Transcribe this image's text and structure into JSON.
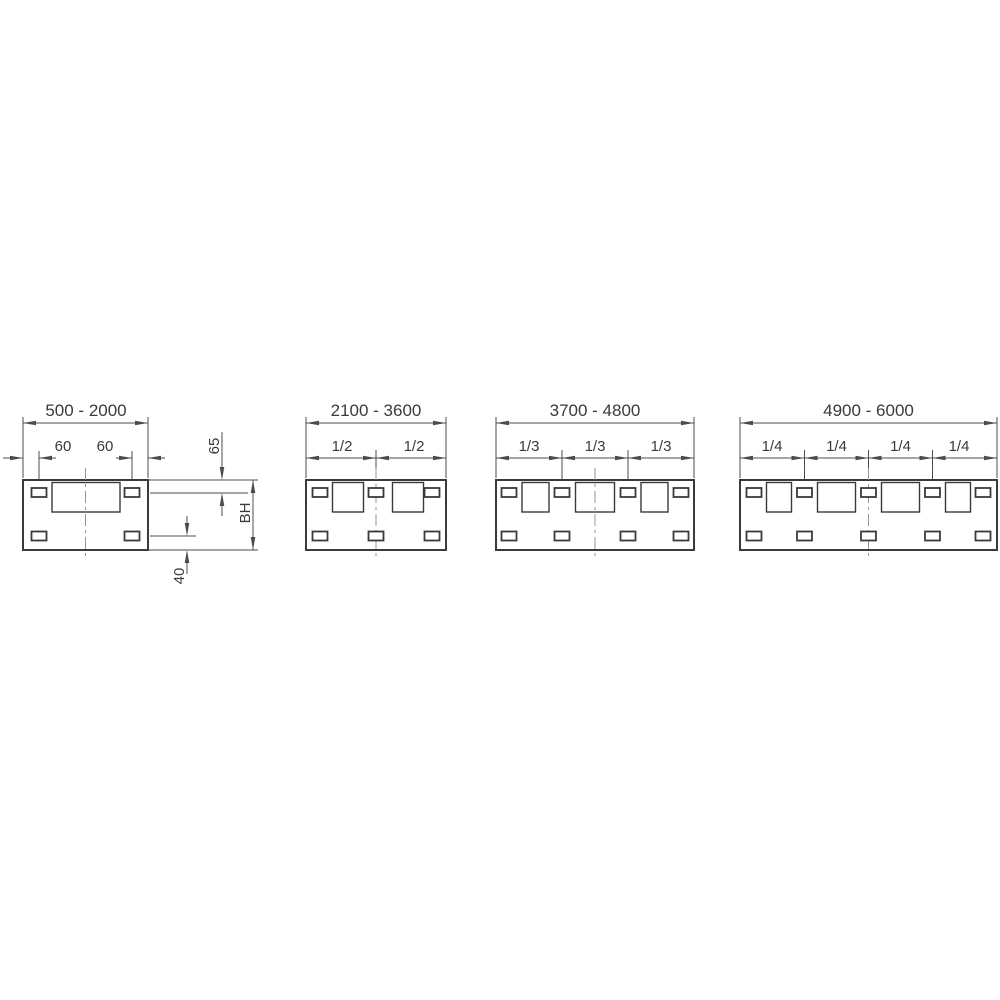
{
  "drawing": {
    "title": "mounting panel size variants dimension diagram",
    "colors": {
      "line": "#3a3a3a",
      "dimension": "#4c4c4c",
      "centerline": "#949494",
      "text": "#3a3a3a",
      "background": "#ffffff"
    },
    "panels": [
      {
        "range": "500 - 2000",
        "offset_left": "60",
        "offset_right": "60",
        "top_inset": "65",
        "body_height": "BH",
        "bottom_inset": "40",
        "cutouts": 1,
        "slots_per_row": 2
      },
      {
        "range": "2100 - 3600",
        "fractions": [
          "1/2",
          "1/2"
        ],
        "cutouts": 2,
        "slots_per_row": 3
      },
      {
        "range": "3700 - 4800",
        "fractions": [
          "1/3",
          "1/3",
          "1/3"
        ],
        "cutouts": 3,
        "slots_per_row": 4
      },
      {
        "range": "4900 - 6000",
        "fractions": [
          "1/4",
          "1/4",
          "1/4",
          "1/4"
        ],
        "cutouts": 4,
        "slots_per_row": 5
      }
    ]
  }
}
